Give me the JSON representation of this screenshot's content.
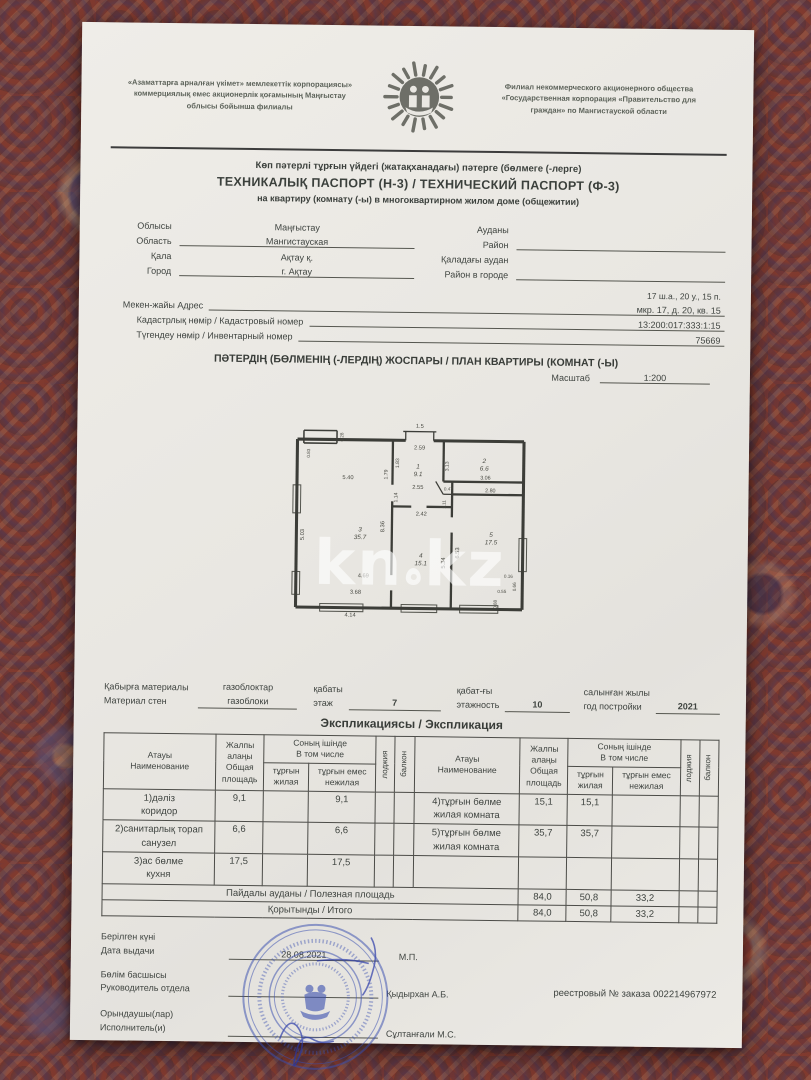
{
  "header": {
    "org_left": "«Азаматтарға арналған үкімет» мемлекеттік корпорациясы»\nкоммерциялық емес акционерлік қоғамының Маңғыстау\nоблысы бойынша филиалы",
    "org_right": "Филиал некоммерческого акционерного общества\n«Государственная корпорация «Правительство для\nграждан» по Мангистауской области"
  },
  "title": {
    "line1": "Көп пәтерлі тұрғын үйдегі (жатақханадағы) пәтерге (бөлмеге (-лерге)",
    "line2": "ТЕХНИКАЛЫҚ ПАСПОРТ (Н-3) / ТЕХНИЧЕСКИЙ ПАСПОРТ (Ф-3)",
    "line3": "на квартиру (комнату (-ы) в многоквартирном жилом доме (общежитии)"
  },
  "fields": {
    "oblast_kz": "Облысы",
    "oblast_ru": "Область",
    "oblast_value_kz": "Маңғыстау",
    "oblast_value_ru": "Мангистауская",
    "city_kz": "Қала",
    "city_ru": "Город",
    "city_value_kz": "Ақтау қ.",
    "city_value_ru": "г. Ақтау",
    "district_kz": "Ауданы",
    "district_ru": "Район",
    "city_district_kz": "Қаладағы аудан",
    "city_district_ru": "Район в городе",
    "address_short": "17 ш.а., 20 у., 15 п.",
    "address_label": "Мекен-жайы Адрес",
    "address_value": "мкр. 17, д. 20, кв. 15",
    "cadastre_label": "Кадастрлық нөмір / Кадастровый номер",
    "cadastre_value": "13:200:017:333:1:15",
    "inventory_label": "Түгендеу нөмір / Инвентарный номер",
    "inventory_value": "75669"
  },
  "plan": {
    "title": "ПӘТЕРДІҢ (БӨЛМЕНІҢ (-ЛЕРДІҢ) ЖОСПАРЫ / ПЛАН КВАРТИРЫ (КОМНАТ (-Ы)",
    "scale_label": "Масштаб",
    "scale_value": "1:200",
    "watermark_left": "kn",
    "watermark_right": "kz"
  },
  "floorplan": {
    "walls": [
      [
        5,
        20,
        90,
        20,
        2.4
      ],
      [
        112,
        20,
        183,
        20,
        2.4
      ],
      [
        5,
        20,
        5,
        152,
        2.4
      ],
      [
        5,
        152,
        183,
        152,
        2.4
      ],
      [
        183,
        20,
        183,
        152,
        2.4
      ],
      [
        10,
        13,
        36,
        13,
        1.2
      ],
      [
        10,
        13,
        10,
        23,
        1.2
      ],
      [
        36,
        13,
        36,
        23,
        1.2
      ],
      [
        10,
        23,
        36,
        23,
        1.2
      ],
      [
        88,
        13,
        114,
        13,
        1
      ],
      [
        90,
        13,
        90,
        20,
        1
      ],
      [
        112,
        13,
        112,
        20,
        1
      ],
      [
        80,
        20,
        80,
        55,
        1.8
      ],
      [
        80,
        68,
        80,
        126,
        1.8
      ],
      [
        80,
        138,
        80,
        152,
        1.8
      ],
      [
        80,
        72,
        95,
        72,
        1.8
      ],
      [
        107,
        72,
        127,
        72,
        1.8
      ],
      [
        120,
        20,
        120,
        52,
        1.8
      ],
      [
        120,
        52,
        183,
        52,
        1.8
      ],
      [
        127,
        62,
        183,
        62,
        1.8
      ],
      [
        127,
        52,
        127,
        80,
        1.8
      ],
      [
        127,
        92,
        127,
        152,
        1.8
      ],
      [
        114,
        52,
        120,
        62,
        1
      ],
      [
        120,
        62,
        127,
        62,
        1
      ]
    ],
    "windows": [
      [
        2,
        56,
        8,
        78
      ],
      [
        24,
        149,
        58,
        155
      ],
      [
        88,
        149,
        116,
        155
      ],
      [
        134,
        149,
        164,
        155
      ],
      [
        180,
        96,
        186,
        122
      ],
      [
        2,
        124,
        8,
        142
      ]
    ],
    "labels": [
      {
        "t": "1.5",
        "x": 101,
        "y": 10,
        "s": 4.5
      },
      {
        "t": "2.59",
        "x": 101,
        "y": 27,
        "s": 4.5
      },
      {
        "t": "1",
        "x": 100,
        "y": 42,
        "s": 5,
        "i": 1
      },
      {
        "t": "9.1",
        "x": 100,
        "y": 48,
        "s": 5,
        "i": 1
      },
      {
        "t": "2.55",
        "x": 100,
        "y": 58,
        "s": 4.5
      },
      {
        "t": "1.83",
        "x": 85,
        "y": 38,
        "s": 4,
        "r": 1
      },
      {
        "t": "1.79",
        "x": 76,
        "y": 47,
        "s": 4,
        "r": 1
      },
      {
        "t": "1.14",
        "x": 84,
        "y": 65,
        "s": 4,
        "r": 1
      },
      {
        "t": "2",
        "x": 152,
        "y": 37,
        "s": 5,
        "i": 1
      },
      {
        "t": "6.6",
        "x": 152,
        "y": 43,
        "s": 5,
        "i": 1
      },
      {
        "t": "3.13",
        "x": 124,
        "y": 40,
        "s": 4,
        "r": 1
      },
      {
        "t": "3.06",
        "x": 153,
        "y": 50,
        "s": 4.2
      },
      {
        "t": "0.47",
        "x": 124,
        "y": 59,
        "s": 3.6
      },
      {
        "t": "2.80",
        "x": 157,
        "y": 60,
        "s": 4.2
      },
      {
        "t": "1.11",
        "x": 122,
        "y": 70,
        "s": 3.6,
        "r": 1
      },
      {
        "t": "5.40",
        "x": 45,
        "y": 51,
        "s": 4.5
      },
      {
        "t": "3",
        "x": 55,
        "y": 92,
        "s": 5,
        "i": 1
      },
      {
        "t": "35.7",
        "x": 55,
        "y": 98,
        "s": 5,
        "i": 1
      },
      {
        "t": "5.03",
        "x": 11,
        "y": 95,
        "s": 4.5,
        "r": 1
      },
      {
        "t": "8.36",
        "x": 74,
        "y": 88,
        "s": 4.5,
        "r": 1
      },
      {
        "t": "4.69",
        "x": 58,
        "y": 128,
        "s": 4.5
      },
      {
        "t": "3.68",
        "x": 52,
        "y": 141,
        "s": 4.5
      },
      {
        "t": "4.14",
        "x": 48,
        "y": 159,
        "s": 4.5
      },
      {
        "t": "0.83",
        "x": 15,
        "y": 31,
        "s": 3.6,
        "r": 1
      },
      {
        "t": "0.28",
        "x": 41,
        "y": 18,
        "s": 3.6,
        "r": 1
      },
      {
        "t": "2.42",
        "x": 103,
        "y": 79,
        "s": 4.5
      },
      {
        "t": "4",
        "x": 103,
        "y": 112,
        "s": 5,
        "i": 1
      },
      {
        "t": "15.1",
        "x": 103,
        "y": 118,
        "s": 5,
        "i": 1
      },
      {
        "t": "5.34",
        "x": 122,
        "y": 116,
        "s": 4.5,
        "r": 1
      },
      {
        "t": "6.53",
        "x": 133,
        "y": 108,
        "s": 4.5,
        "r": 1
      },
      {
        "t": "5",
        "x": 158,
        "y": 95,
        "s": 5,
        "i": 1
      },
      {
        "t": "17.5",
        "x": 158,
        "y": 101,
        "s": 5,
        "i": 1
      },
      {
        "t": "0.16",
        "x": 172,
        "y": 127,
        "s": 3.6
      },
      {
        "t": "0.55",
        "x": 167,
        "y": 139,
        "s": 3.6
      },
      {
        "t": "0.66",
        "x": 178,
        "y": 134,
        "s": 3.6,
        "r": 1
      },
      {
        "t": "0.88",
        "x": 163,
        "y": 148,
        "s": 3.6,
        "r": 1
      }
    ]
  },
  "materials": {
    "wall_label": "Қабырға материалы\nМатериал стен",
    "wall_value": "газоблоктар\nгазоблоки",
    "floor_label": "қабаты\nэтаж",
    "floor_value": "7",
    "floors_label": "қабат-ғы\nэтажность",
    "floors_value": "10",
    "year_label": "салынған жылы\nгод постройки",
    "year_value": "2021"
  },
  "explication": {
    "heading": "Экспликациясы / Экспликация",
    "col_name": "Атауы\nНаименование",
    "col_total": "Жалпы\nалаңы\nОбщая\nплощадь",
    "col_incl": "Соның ішінде\nВ том числе",
    "col_living": "тұрғын\nжилая",
    "col_nonliving": "тұрғын емес\nнежилая",
    "col_loggia": "лоджия",
    "col_balcony": "балкон",
    "body": [
      [
        "1)дәліз\nкоридор",
        "9,1",
        "",
        "9,1",
        "",
        "",
        "4)тұрғын бөлме\nжилая комната",
        "15,1",
        "15,1",
        "",
        "",
        ""
      ],
      [
        "2)санитарлық торап\nсанузел",
        "6,6",
        "",
        "6,6",
        "",
        "",
        "5)тұрғын бөлме\nжилая комната",
        "35,7",
        "35,7",
        "",
        "",
        ""
      ],
      [
        "3)ас бөлме\nкухня",
        "17,5",
        "",
        "17,5",
        "",
        "",
        "",
        "",
        "",
        "",
        "",
        ""
      ]
    ],
    "totals": [
      {
        "label": "Пайдалы ауданы / Полезная площадь",
        "values": [
          "84,0",
          "50,8",
          "33,2",
          "",
          ""
        ]
      },
      {
        "label": "Қорытынды / Итого",
        "values": [
          "84,0",
          "50,8",
          "33,2",
          "",
          ""
        ]
      }
    ]
  },
  "footer": {
    "date_label": "Берілген күні\nДата выдачи",
    "date_value": "28.08.2021",
    "mp": "М.П.",
    "head_label": "Бөлім басшысы\nРуководитель отдела",
    "head_name": "Қыдырхан А.Б.",
    "executor_label": "Орындаушы(лар)\nИсполнитель(и)",
    "executor_name": "Сұлтанғали М.С.",
    "registry": "реестровый № заказа 002214967972"
  }
}
